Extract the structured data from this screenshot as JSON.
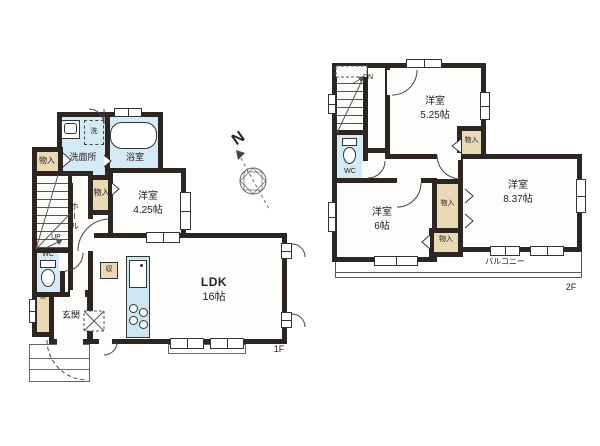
{
  "colors": {
    "wall": "#2d2522",
    "wet_area": "#d4eaf4",
    "closet": "#e9d9b5",
    "line": "#444444"
  },
  "compass": {
    "north": "N"
  },
  "floor1": {
    "label": "1F",
    "rooms": {
      "washroom": "洗面所",
      "bath": "浴室",
      "laundry": "洗",
      "storage_nw": "物入",
      "storage_mid": "物入",
      "western_room": {
        "name": "洋室",
        "size": "4.25帖"
      },
      "ldk": {
        "name": "LDK",
        "size": "16帖"
      },
      "hall": "ホール",
      "stairs": "UP",
      "wc": "WC",
      "meter": "M",
      "entrance": "玄関",
      "storage_kitchen": "収"
    }
  },
  "floor2": {
    "label": "2F",
    "rooms": {
      "stairs": "DN",
      "wc": "WC",
      "western_room_a": {
        "name": "洋室",
        "size": "5.25帖"
      },
      "storage_a": "物入",
      "western_room_b": {
        "name": "洋室",
        "size": "8.37帖"
      },
      "storage_b": "物入",
      "storage_c": "物入",
      "western_room_c": {
        "name": "洋室",
        "size": "6帖"
      },
      "balcony": "バルコニー"
    }
  }
}
